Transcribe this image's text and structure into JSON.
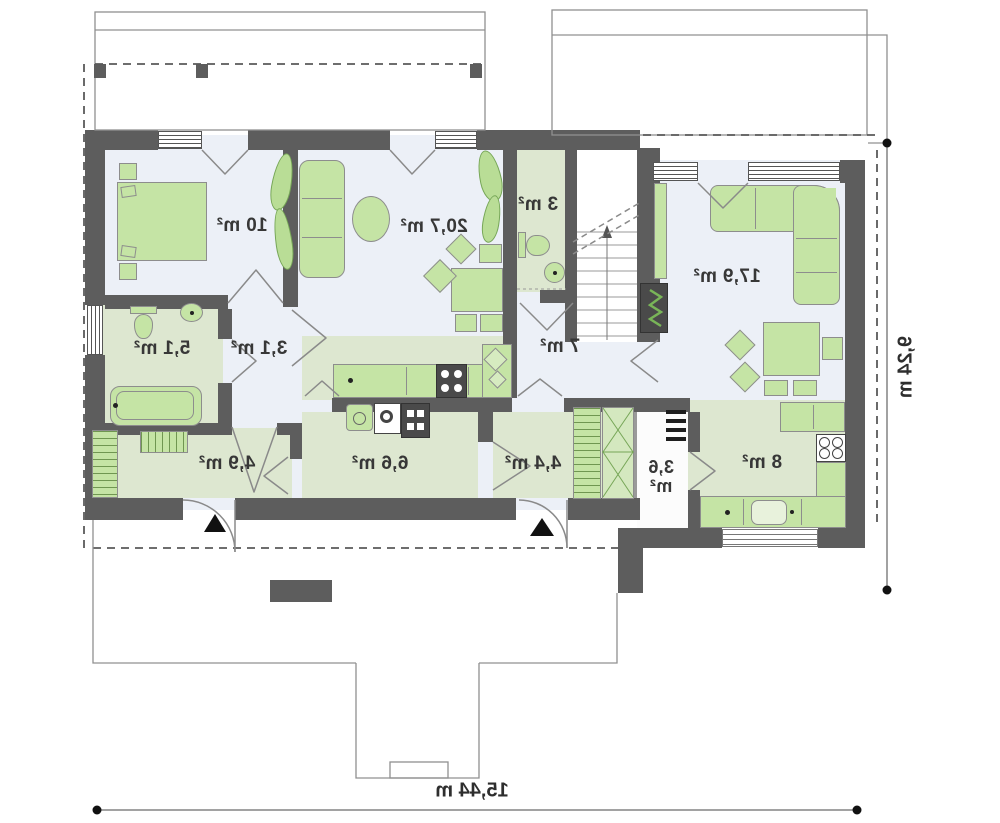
{
  "plan": {
    "kind": "ground-floor plan (mirrored presentation)",
    "rooms": {
      "bedroom": {
        "label": "10 m²"
      },
      "living_room": {
        "label": "20,7 m²"
      },
      "wc": {
        "label": "3 m²"
      },
      "family_room": {
        "label": "17,9 m²"
      },
      "bathroom": {
        "label": "5,1 m²"
      },
      "hall_small": {
        "label": "3,1 m²"
      },
      "hall": {
        "label": "7 m²"
      },
      "corridor": {
        "label": "4,9 m²"
      },
      "utility_room": {
        "label": "6,6 m²"
      },
      "entry": {
        "label": "4,4 m²"
      },
      "pantry": {
        "label_line1": "3,6",
        "label_line2": "m²"
      },
      "kitchen": {
        "label": "8 m²"
      }
    },
    "dimensions": {
      "overall_width": "15,44 m",
      "overall_depth": "9,24 m"
    },
    "colors": {
      "wall": "#5d5d5d",
      "floor": "#ecf0f7",
      "floor_green": "#dde7d0",
      "furniture": "#c5e4a5",
      "furniture_accent": "#76a657"
    }
  }
}
